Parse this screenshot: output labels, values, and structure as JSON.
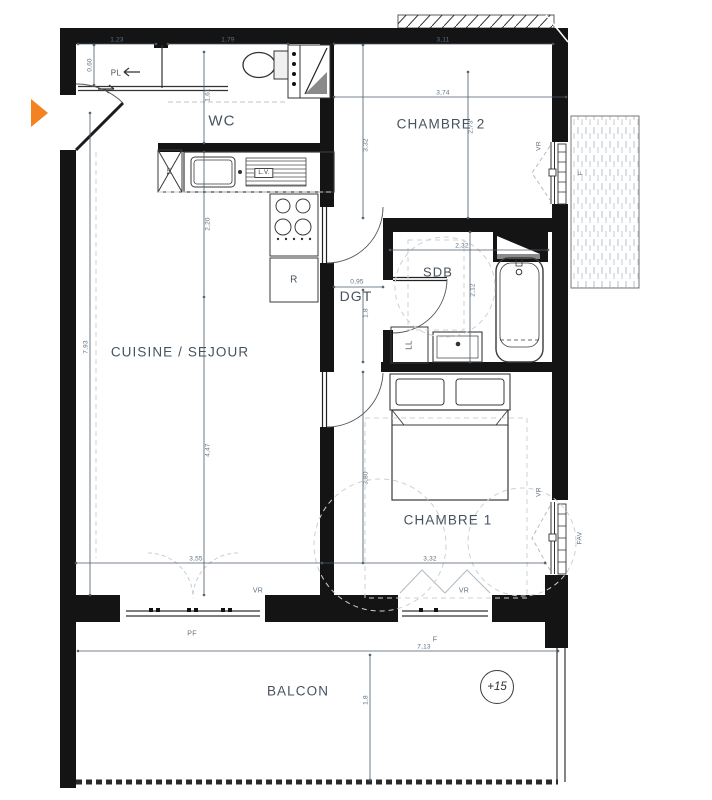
{
  "colors": {
    "wall": "#141414",
    "accent_orange": "#F58220",
    "dimension_text": "#5D7080",
    "room_label_text": "#46535F"
  },
  "entrance_marker_icon": "right-triangle-arrow",
  "rooms": {
    "pl": "PL",
    "wc": "WC",
    "chambre2": "CHAMBRE 2",
    "cuisine": "CUISINE / SEJOUR",
    "sdb": "SDB",
    "dgt": "DGT",
    "chambre1": "CHAMBRE 1",
    "balcon": "BALCON"
  },
  "fixtures": {
    "tableau_electrique": "TE",
    "lave_vaisselle": "L.V.",
    "refrigerateur": "R",
    "lave_linge": "LL"
  },
  "openings": {
    "vr": "VR",
    "f": "F",
    "pf": "PF",
    "fav": "FAV"
  },
  "level": {
    "value": "+15"
  },
  "dims": {
    "pl_width": "1,23",
    "pl_depth": "0,60",
    "wc_width": "1,79",
    "wc_depth": "1,61",
    "ch2_top": "3,11",
    "ch2_width": "3,74",
    "ch2_left": "3,32",
    "ch2_height": "2,73",
    "kitchen_depth": "2,20",
    "sejour_height": "7,93",
    "sejour_inner": "4,47",
    "sejour_width": "3,55",
    "dgt_width": "0,95",
    "dgt_height": "1,8",
    "sdb_width": "2,32",
    "sdb_height": "2,12",
    "ch1_height": "3,80",
    "ch1_width": "3,32",
    "balcon_width": "7,13",
    "balcon_depth": "1,8"
  }
}
